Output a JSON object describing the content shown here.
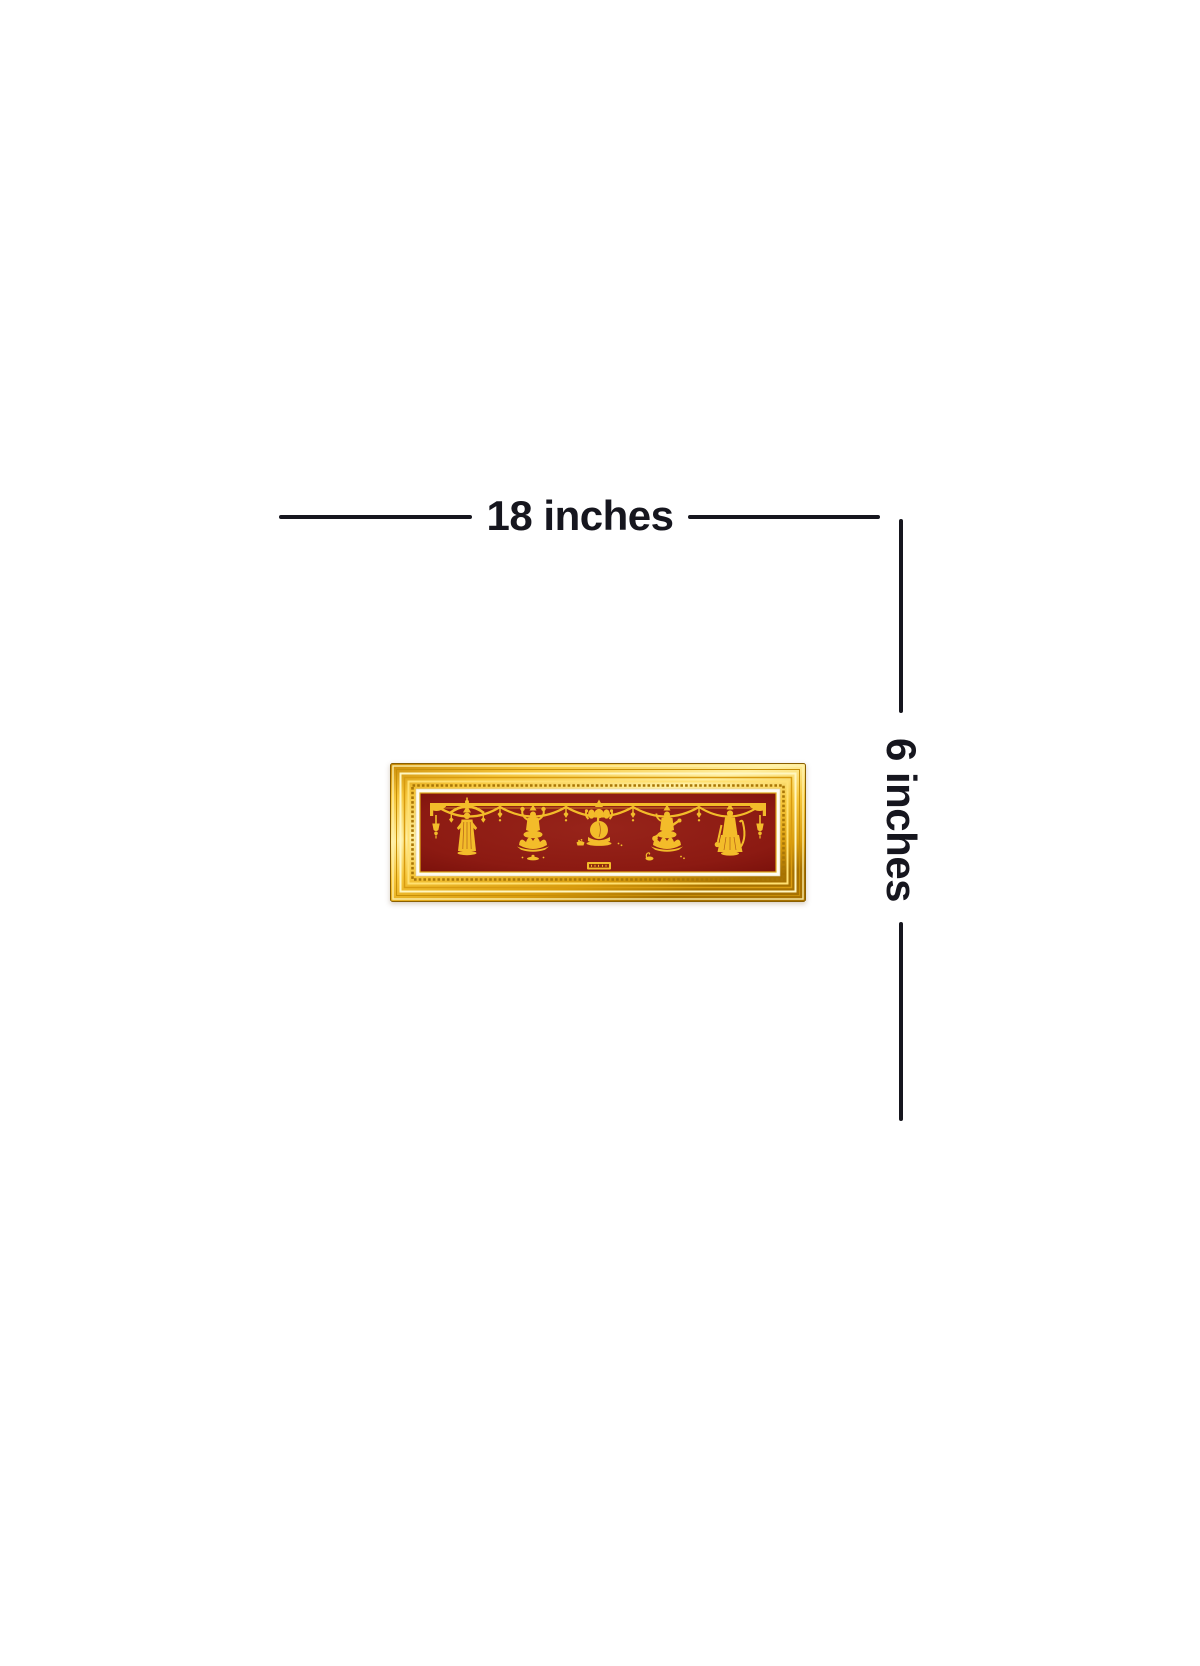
{
  "page": {
    "type": "product-dimension-diagram",
    "background_color": "#ffffff"
  },
  "dimensions": {
    "width": {
      "label": "18 inches"
    },
    "height": {
      "label": "6 inches"
    },
    "annotation_color": "#16161e"
  },
  "artwork": {
    "kind": "gold-frame-deity-wall-panel",
    "deity_icons": [
      "deity-balaji-icon",
      "deity-lakshmi-icon",
      "deity-ganesha-icon",
      "deity-saraswati-icon",
      "deity-hanuman-icon"
    ],
    "ornament_icons": [
      "toran-garland-icon",
      "tassel-left-icon",
      "tassel-right-icon",
      "shubh-labh-plaque"
    ],
    "colors": {
      "frame_gold": "#f6c63a",
      "frame_gold_light": "#ffefa0",
      "frame_gold_dark": "#a87200",
      "mat_white": "#fffcf0",
      "background_maroon": "#8c1a12",
      "figure_gold": "#f3bc2a"
    }
  }
}
